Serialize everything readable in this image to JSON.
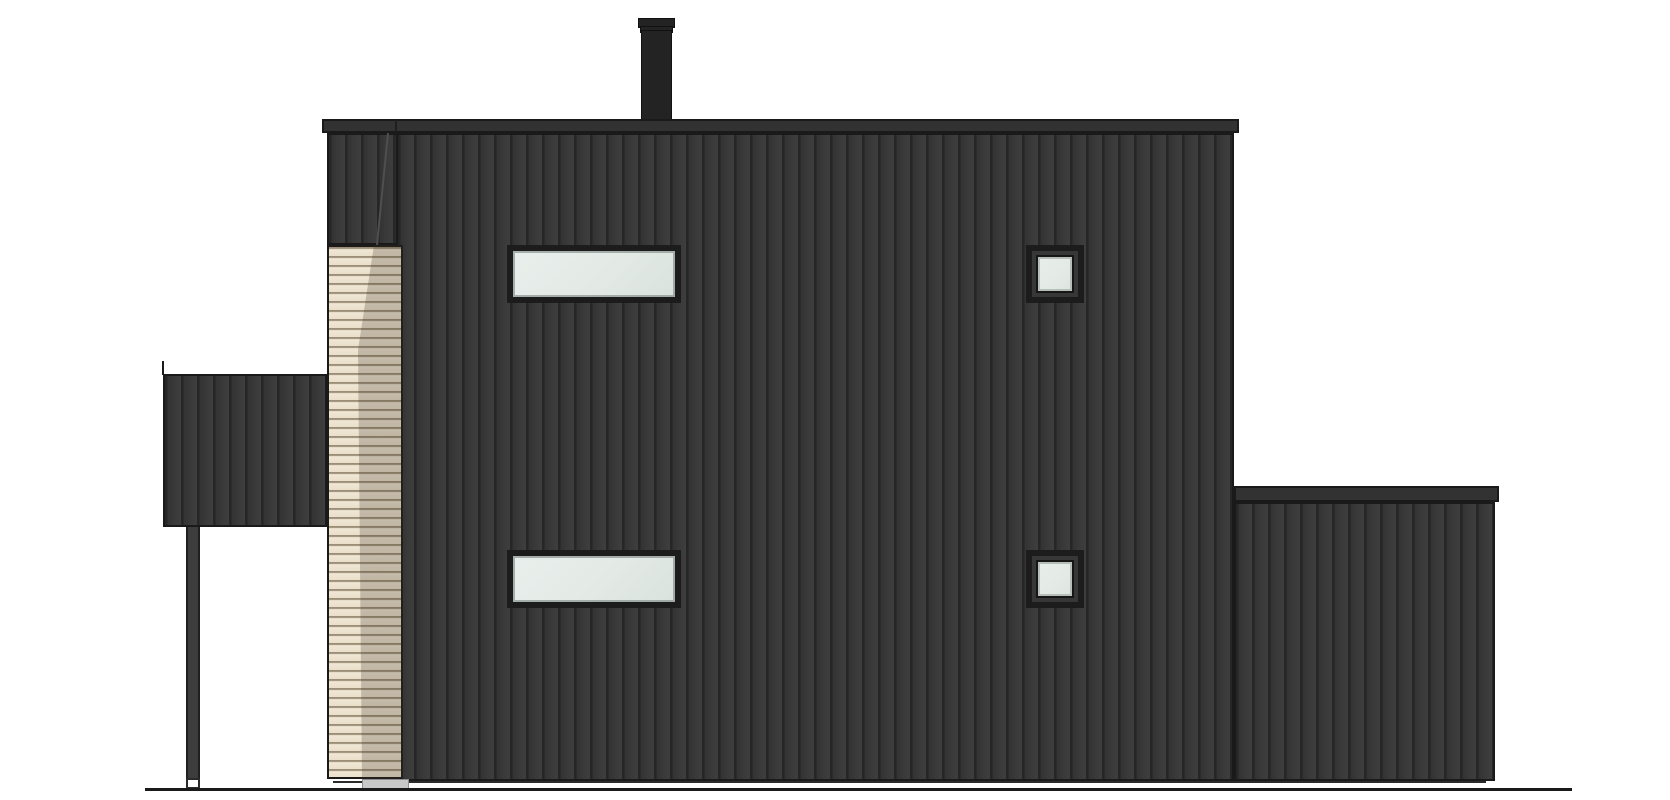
{
  "scene": {
    "type": "architectural-elevation-drawing",
    "subject": "house-side-elevation",
    "parts": [
      {
        "name": "chimney",
        "count": 1
      },
      {
        "name": "main-roof-fascia",
        "count": 1
      },
      {
        "name": "main-wall-dark-vertical-cladding",
        "count": 1
      },
      {
        "name": "wood-slat-column-strip",
        "count": 1
      },
      {
        "name": "ribbon-window",
        "count": 2
      },
      {
        "name": "square-window",
        "count": 2
      },
      {
        "name": "left-canopy",
        "count": 1
      },
      {
        "name": "canopy-post",
        "count": 1
      },
      {
        "name": "right-extension",
        "count": 1
      },
      {
        "name": "foundation-strip",
        "count": 1
      },
      {
        "name": "ground-line",
        "count": 1
      }
    ]
  },
  "colors": {
    "background": "#ffffff",
    "cladding_dark": "#3a3a3a",
    "cladding_groove": "#262626",
    "outline": "#1a1a1a",
    "fascia": "#323232",
    "wood_light": "#e9dfca",
    "wood_slat_line": "#9c8e76",
    "wood_shadow_overlay": "rgba(62,52,36,0.24)",
    "glass": "#e3eae6",
    "frame_black": "#1c1c1c",
    "plinth_gray": "#c8c8c8",
    "chimney_black": "#232323"
  }
}
